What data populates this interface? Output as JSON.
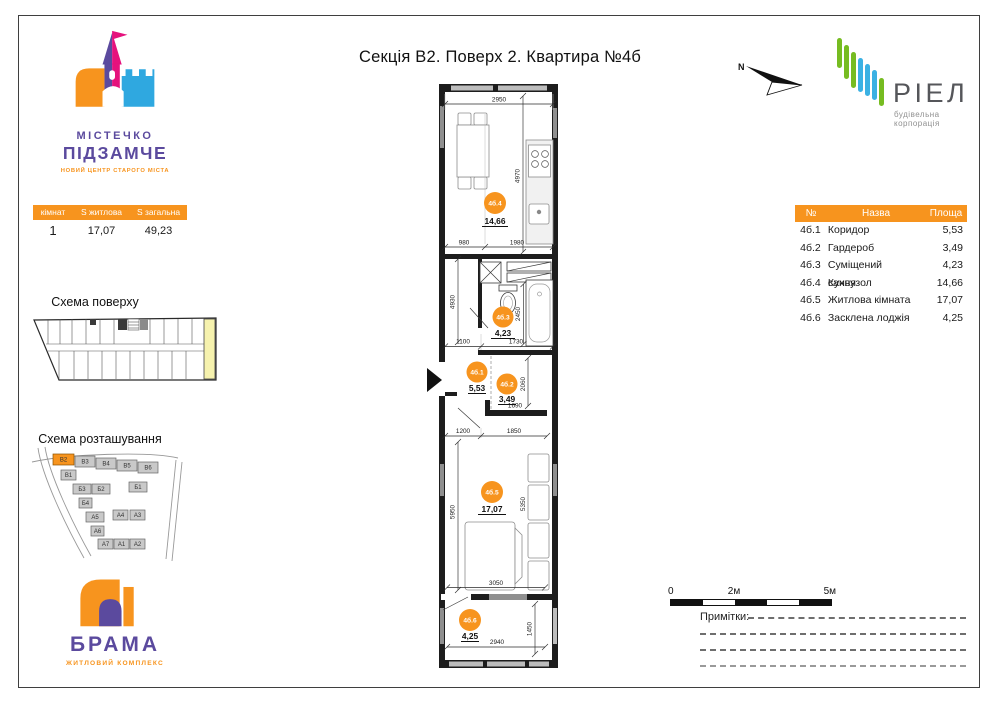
{
  "title": "Секція В2. Поверх 2. Квартира №4б",
  "colors": {
    "accent_orange": "#F7941E",
    "brand_purple": "#5B4A9E",
    "brand_pink": "#E5127D",
    "brand_blue": "#2FA8E0",
    "riel_green": "#76BC21",
    "riel_blue": "#3BB1E3",
    "highlight_yellow": "#F6F2AE"
  },
  "left_panel": {
    "logo": {
      "line1": "МІСТЕЧКО",
      "line2": "ПІДЗАМЧЕ",
      "tagline": "НОВИЙ ЦЕНТР СТАРОГО МІСТА"
    },
    "stats": {
      "headers": [
        "кімнат",
        "S житлова",
        "S загальна"
      ],
      "values": [
        "1",
        "17,07",
        "49,23"
      ]
    },
    "floor_scheme_title": "Схема поверху",
    "site_scheme_title": "Схема розташування",
    "site_blocks": [
      "В2",
      "В3",
      "В4",
      "В5",
      "В6",
      "В1",
      "Б3",
      "Б2",
      "Б1",
      "Б4",
      "А5",
      "А4",
      "А3",
      "А6",
      "А7",
      "А1",
      "А2"
    ],
    "brama": {
      "name": "БРАМА",
      "tagline": "ЖИТЛОВИЙ КОМПЛЕКС"
    }
  },
  "plan": {
    "rooms": [
      {
        "id": "4б.4",
        "area": "14,66"
      },
      {
        "id": "4б.3",
        "area": "4,23"
      },
      {
        "id": "4б.1",
        "area": "5,53"
      },
      {
        "id": "4б.2",
        "area": "3,49"
      },
      {
        "id": "4б.5",
        "area": "17,07"
      },
      {
        "id": "4б.6",
        "area": "4,25"
      }
    ],
    "dims": [
      "2950",
      "4970",
      "980",
      "1980",
      "4930",
      "2450",
      "1100",
      "1730",
      "2060",
      "1690",
      "1850",
      "1200",
      "5950",
      "5350",
      "3050",
      "2940",
      "1450"
    ]
  },
  "right_panel": {
    "north_label": "N",
    "riel": {
      "name": "РІЕЛ",
      "tagline": "будівельна корпорація"
    },
    "rooms_table": {
      "headers": [
        "№",
        "Назва",
        "Площа"
      ],
      "rows": [
        {
          "num": "4б.1",
          "name": "Коридор",
          "area": "5,53"
        },
        {
          "num": "4б.2",
          "name": "Гардероб",
          "area": "3,49"
        },
        {
          "num": "4б.3",
          "name": "Суміщений санвузол",
          "area": "4,23"
        },
        {
          "num": "4б.4",
          "name": "Кухня",
          "area": "14,66"
        },
        {
          "num": "4б.5",
          "name": "Житлова кімната",
          "area": "17,07"
        },
        {
          "num": "4б.6",
          "name": "Засклена лоджія",
          "area": "4,25"
        }
      ]
    },
    "scale": {
      "labels": [
        "0",
        "2м",
        "5м"
      ]
    },
    "notes_label": "Примітки:"
  }
}
